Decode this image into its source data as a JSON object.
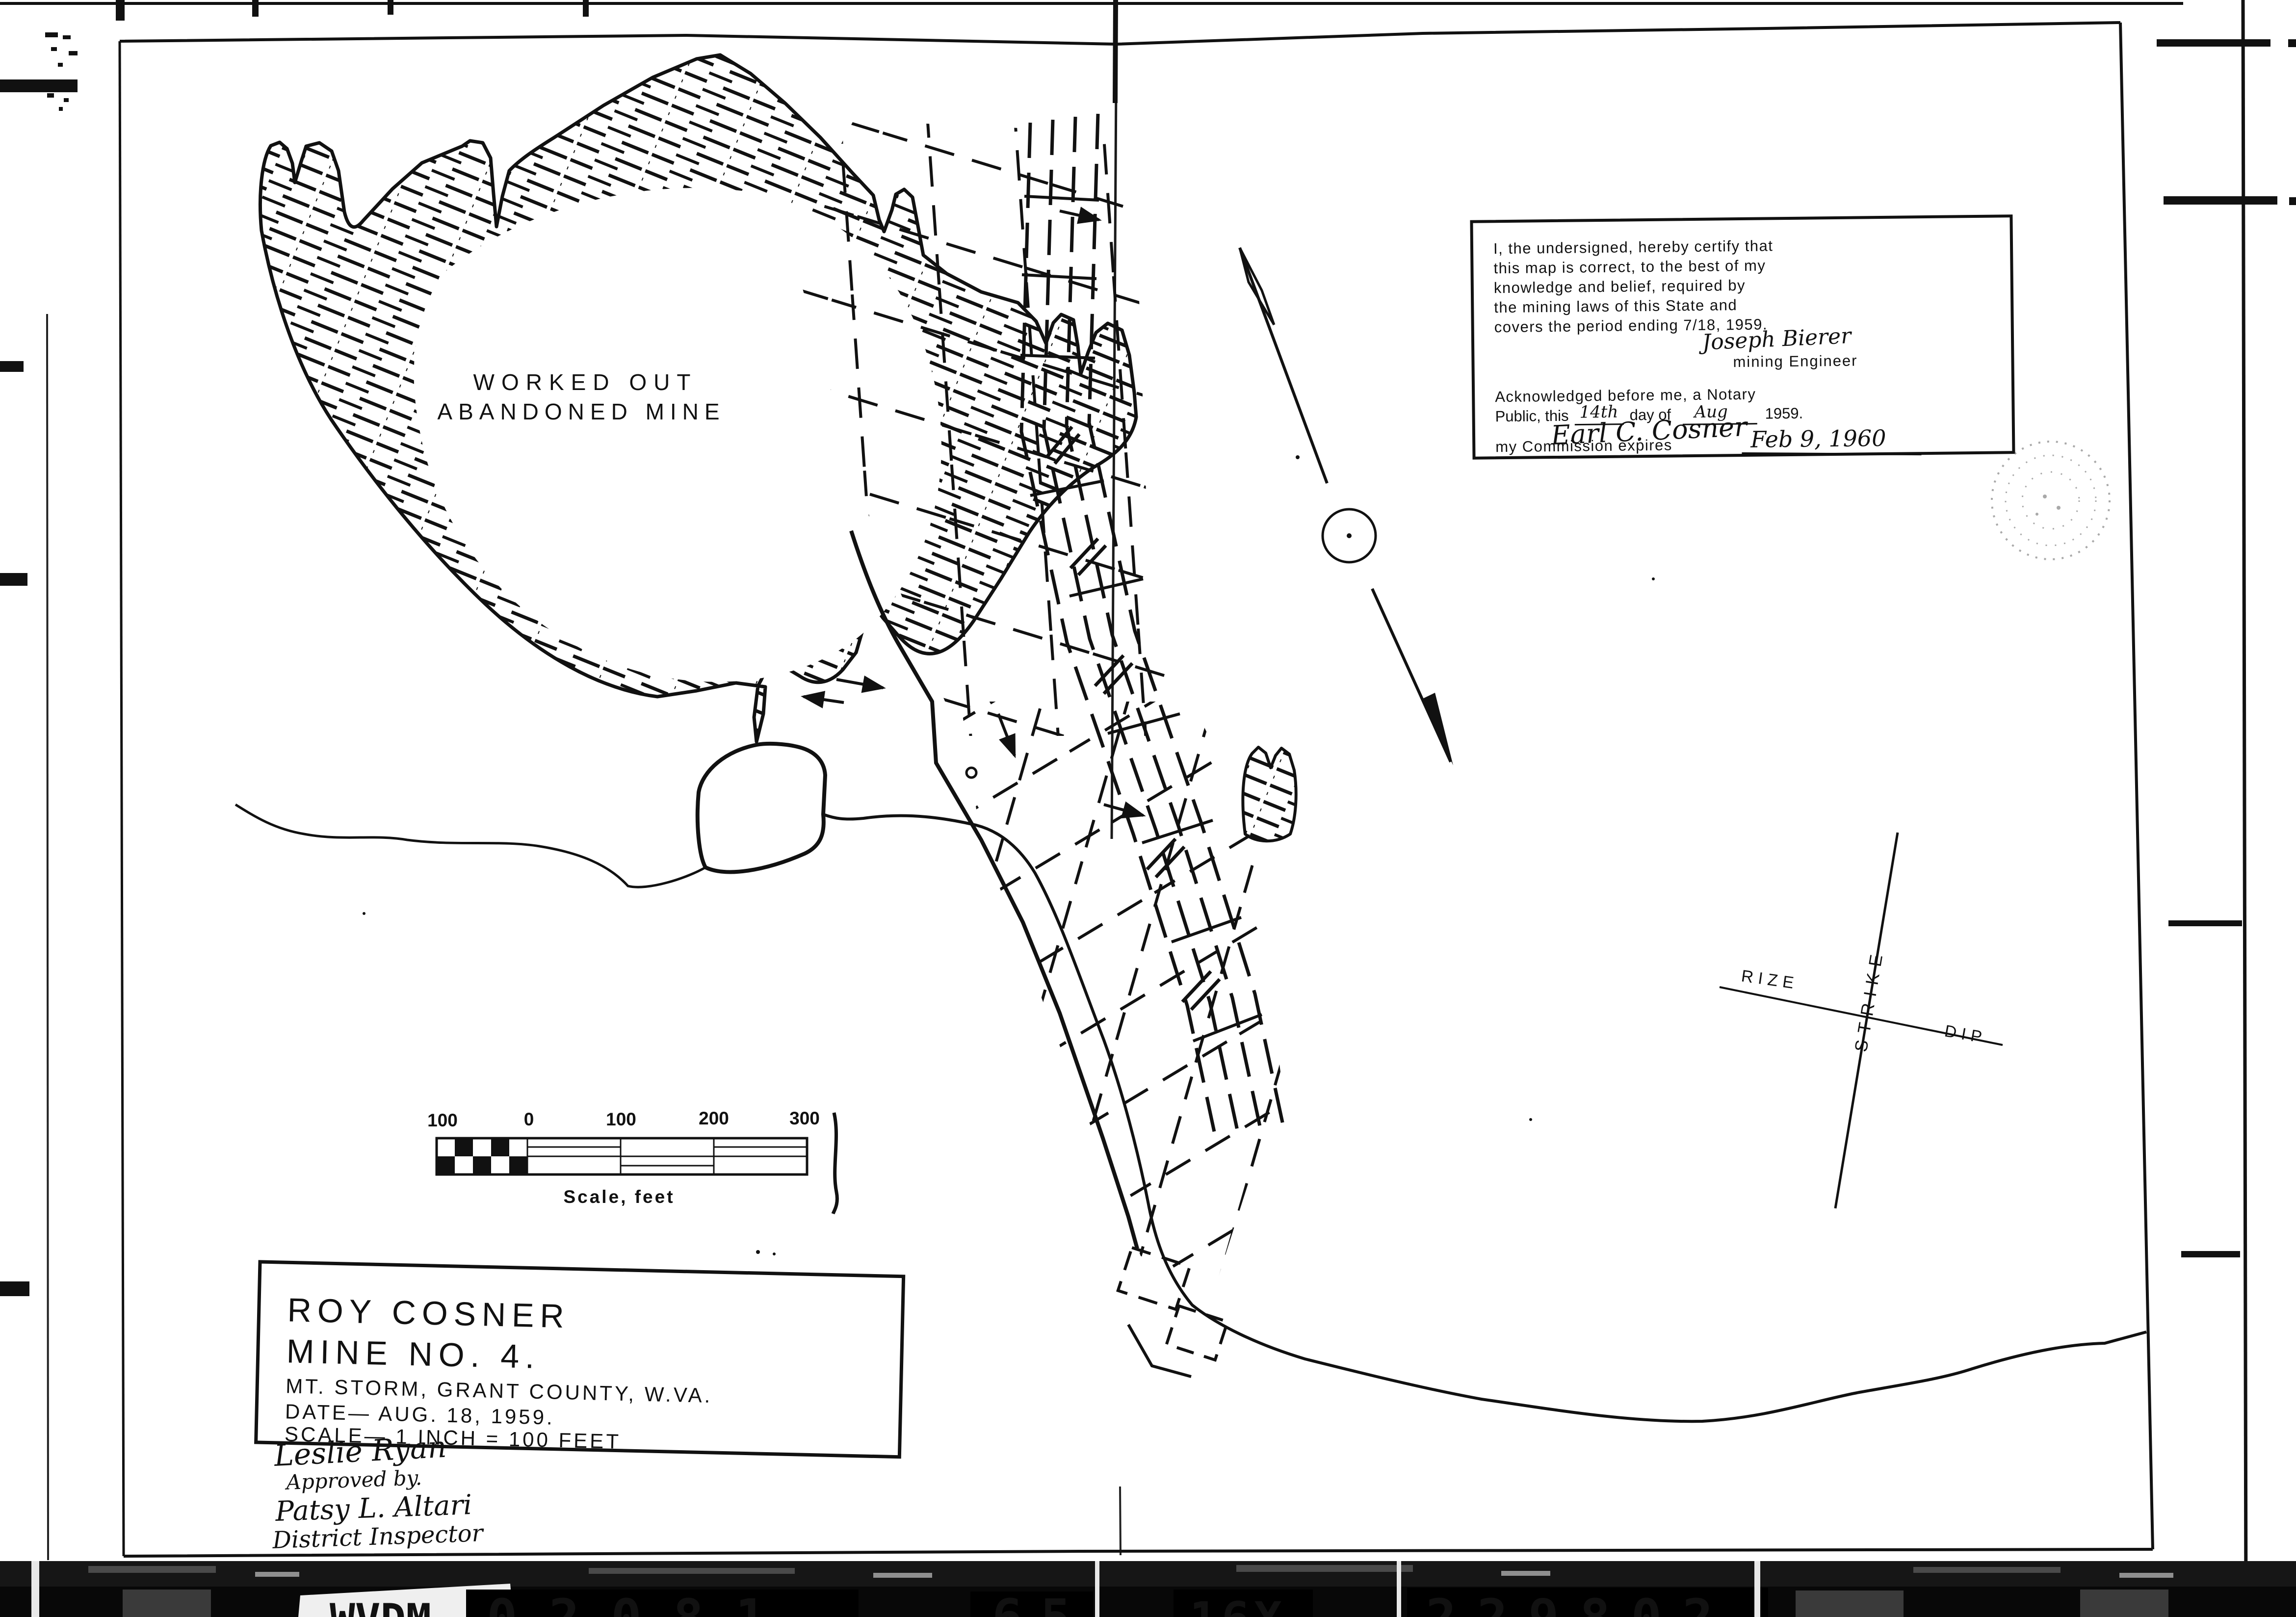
{
  "map_labels": {
    "worked_out1": "WORKED OUT",
    "worked_out2": "ABANDONED MINE"
  },
  "certification": {
    "line1": "I, the undersigned, hereby certify that",
    "line2": "this map is correct, to the best of my",
    "line3": "knowledge and belief, required by",
    "line4": "the mining laws of this State and",
    "line5": "covers the period ending 7/18, 1959.",
    "engineer_signature": "Joseph Bierer",
    "engineer_title": "mining Engineer",
    "notary_line1": "Acknowledged before me, a Notary",
    "notary_prefix": "Public, this",
    "notary_day": "14th",
    "notary_mid": "day of",
    "notary_month": "Aug",
    "notary_year": "1959.",
    "notary_signature": "Earl C. Cosner",
    "commission_prefix": "my Commission expires",
    "commission_date": "Feb 9, 1960"
  },
  "orientation": {
    "strike": "STRIKE",
    "rize": "RIZE",
    "dip": "DIP"
  },
  "scale_bar": {
    "labels": [
      "100",
      "0",
      "100",
      "200",
      "300"
    ],
    "caption": "Scale, feet"
  },
  "title_block": {
    "line1": "ROY COSNER",
    "line2": "MINE NO. 4.",
    "line3": "MT. STORM, GRANT COUNTY, W.VA.",
    "line4": "DATE— AUG. 18, 1959.",
    "line5": "SCALE— 1 INCH = 100 FEET"
  },
  "approvals": {
    "surveyor_signature": "Leslie Ryan",
    "approved_by": "Approved by.",
    "inspector_signature": "Patsy L. Altari",
    "inspector_title": "District Inspector"
  },
  "film_strip": {
    "agency": "WVDM",
    "id1": "02081",
    "id2": "65",
    "id3": "16X",
    "id4": "229802"
  },
  "colors": {
    "ink": "#111111",
    "paper": "#ffffff",
    "strip_bg": "#080808",
    "strip_text": "#f7f7f7"
  }
}
